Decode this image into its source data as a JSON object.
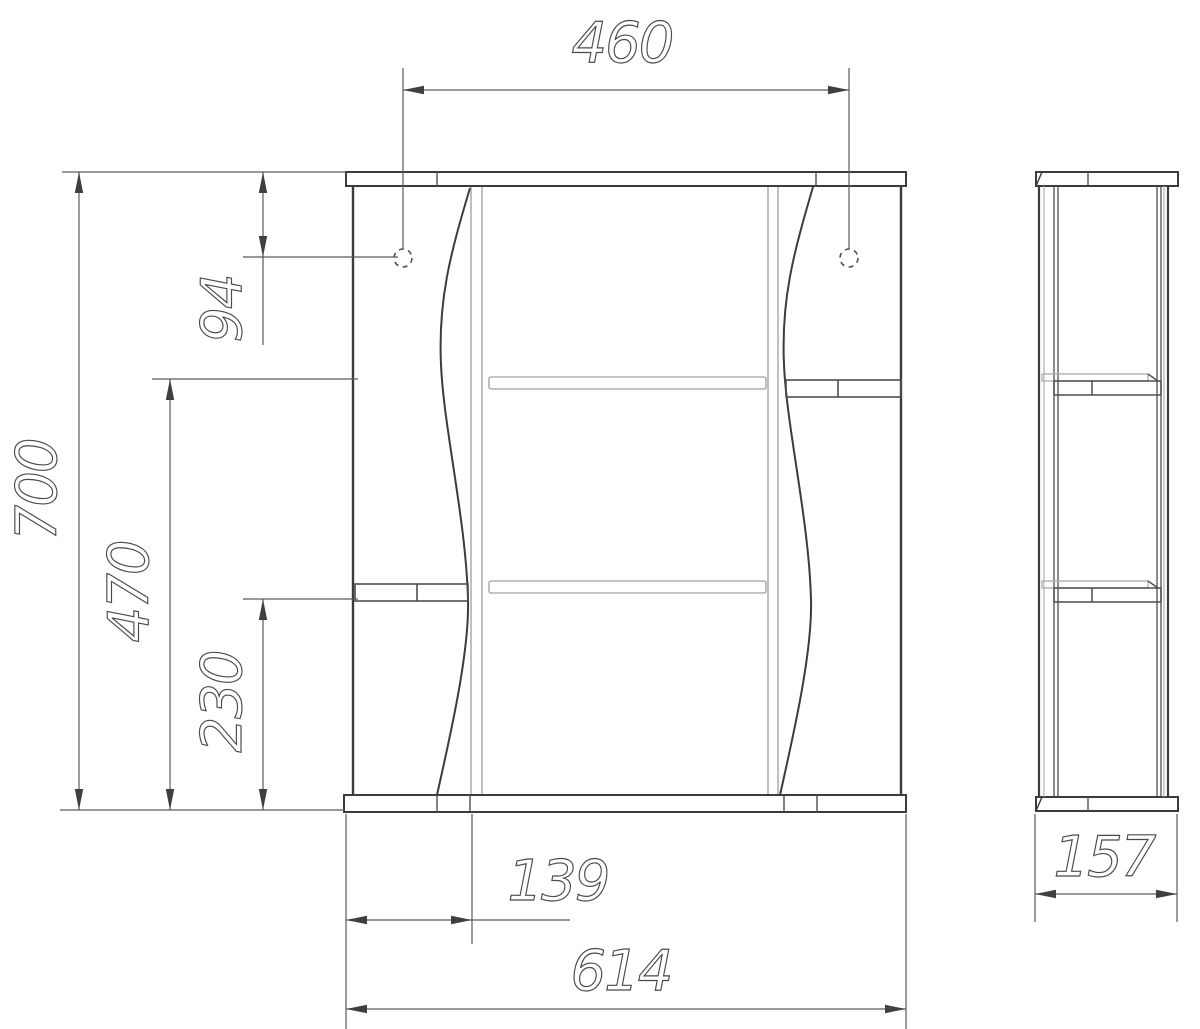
{
  "drawing": {
    "type": "furniture-technical-drawing",
    "views": {
      "front": "front-view",
      "side": "side-view"
    },
    "colors": {
      "background": "#ffffff",
      "main_line": "#3c3c3c",
      "thin_line": "#4e4e4e",
      "light_line": "#b0b0b0",
      "dimension_text": "#4a4a4a"
    },
    "dimensions": {
      "hinge_span_width": "460",
      "overall_height": "700",
      "hinge_top_offset": "94",
      "upper_shelf_height": "470",
      "lower_shelf_height": "230",
      "left_section_width": "139",
      "overall_width": "614",
      "depth": "157"
    }
  }
}
